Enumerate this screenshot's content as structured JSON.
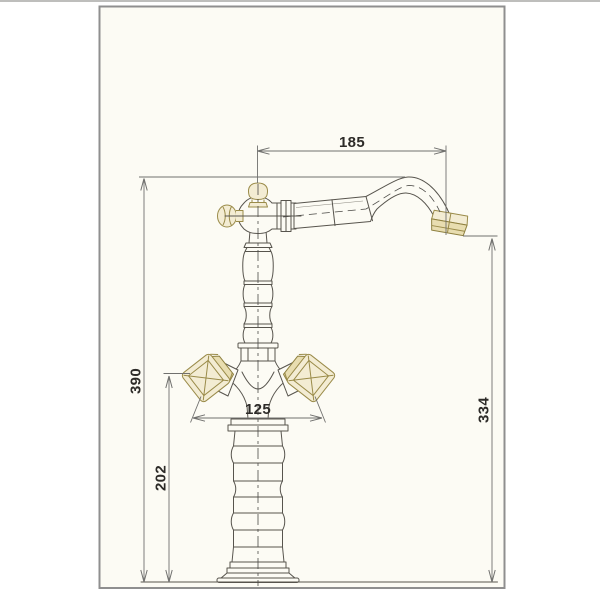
{
  "title": "Faucet technical dimension drawing",
  "drawing": {
    "subject": "two-handle classic single-hole faucet, front elevation",
    "dims": {
      "reach": "185",
      "overall_height": "390",
      "outlet_height": "334",
      "handle_span": "125",
      "lower_height": "202"
    },
    "dimension_list": [
      {
        "name": "spout reach (center axis to aerator)",
        "value": "185",
        "orientation": "horizontal"
      },
      {
        "name": "overall height (base to spout top)",
        "value": "390",
        "orientation": "vertical"
      },
      {
        "name": "aerator outlet height above base",
        "value": "334",
        "orientation": "vertical"
      },
      {
        "name": "span across cross handles",
        "value": "125",
        "orientation": "horizontal"
      },
      {
        "name": "base to handle centerline",
        "value": "202",
        "orientation": "vertical"
      }
    ],
    "colors": {
      "paper": "#fcfbf4",
      "frame_border": "#8f8f8f",
      "outline": "#57544d",
      "dimension_lines": "#70706e",
      "dimension_text": "#2d2b28",
      "brass_accent_stroke": "#9a8b49",
      "brass_accent_fill": "#f3ecd3"
    }
  }
}
